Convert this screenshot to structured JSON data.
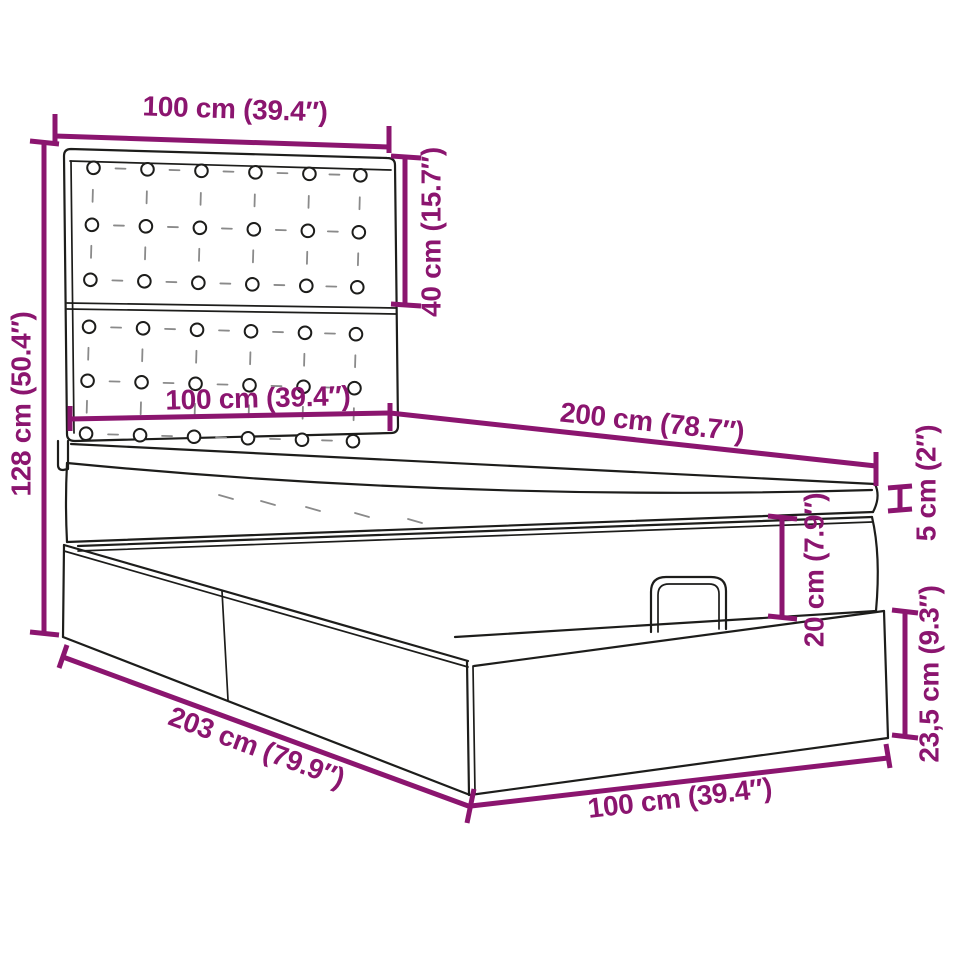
{
  "title": "Ottoman bed dimension diagram",
  "colors": {
    "dimension_accent": "#8B156F",
    "outline": "#1D1D1B",
    "background": "#FFFFFF"
  },
  "product": {
    "parts": [
      "tufted headboard",
      "mattress",
      "ottoman storage lid with handle",
      "storage base with two panels"
    ]
  },
  "dimensions": [
    {
      "id": "headboard-width-top",
      "label": "100 cm (39.4″)"
    },
    {
      "id": "headboard-upper-section-height",
      "label": "40 cm (15.7″)"
    },
    {
      "id": "headboard-total-height",
      "label": "128 cm (50.4″)"
    },
    {
      "id": "bed-width-at-headboard",
      "label": "100 cm (39.4″)"
    },
    {
      "id": "bed-length-top",
      "label": "200 cm (78.7″)"
    },
    {
      "id": "mattress-thickness",
      "label": "5 cm (2″)"
    },
    {
      "id": "ottoman-section-height",
      "label": "20 cm (7.9″)"
    },
    {
      "id": "base-height",
      "label": "23,5 cm (9.3″)"
    },
    {
      "id": "base-length-diagonal",
      "label": "203 cm (79.9″)"
    },
    {
      "id": "base-width-bottom",
      "label": "100 cm (39.4″)"
    }
  ]
}
